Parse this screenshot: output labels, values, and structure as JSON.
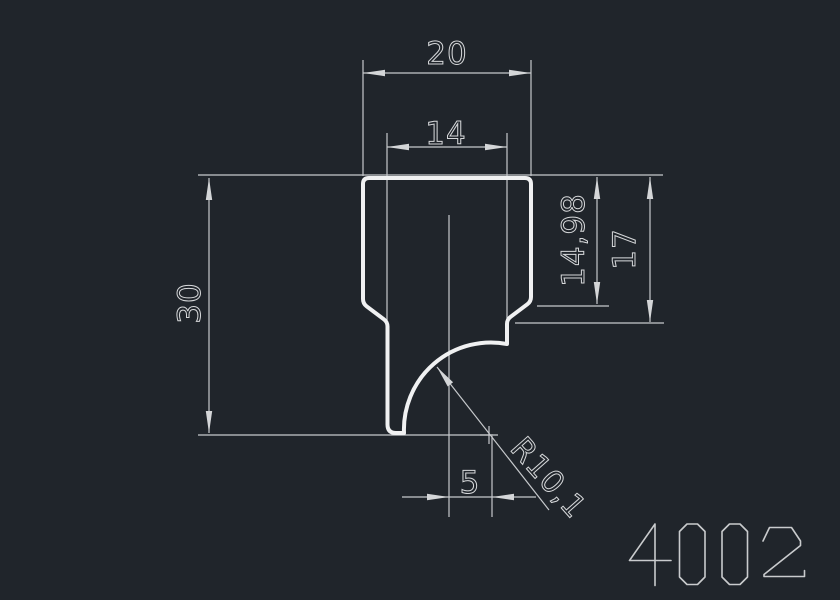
{
  "drawing": {
    "part_number": "4002",
    "dimensions": {
      "top_width": "20",
      "stem_width": "14",
      "total_height": "30",
      "upper_height": "14,98",
      "shoulder_height": "17",
      "center_offset": "5",
      "radius": "R10,1"
    },
    "colors": {
      "background": "#20252b",
      "profile_line": "#f0f1f2",
      "dimension_line": "#c6c9cc",
      "text": "#d6d8da"
    }
  }
}
